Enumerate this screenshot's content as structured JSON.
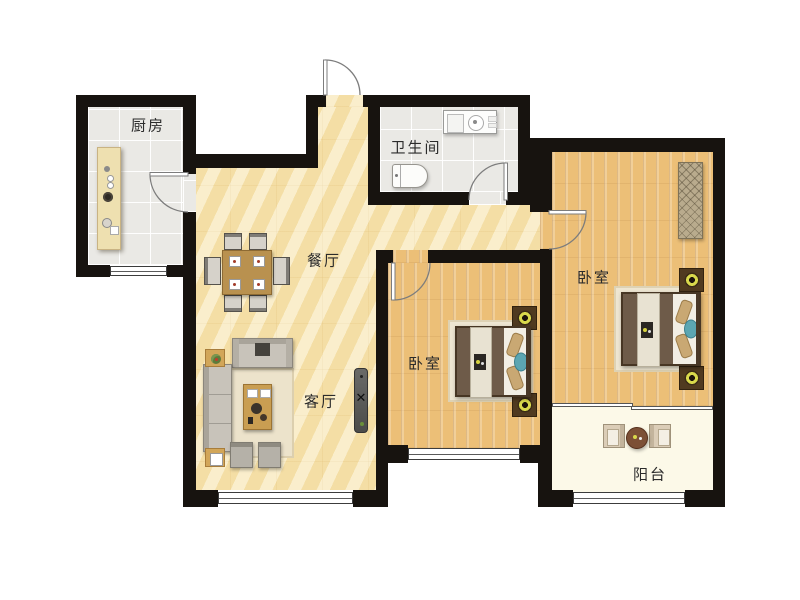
{
  "floorplan": {
    "rooms": {
      "kitchen": {
        "label": "厨房"
      },
      "bathroom": {
        "label": "卫生间"
      },
      "dining": {
        "label": "餐厅"
      },
      "living": {
        "label": "客厅"
      },
      "bedroom_middle": {
        "label": "卧室"
      },
      "bedroom_right": {
        "label": "卧室"
      },
      "balcony": {
        "label": "阳台"
      }
    },
    "colors": {
      "wall": "#17130f",
      "marble_floor": "#f5e2ae",
      "wood_floor": "#ecbf77",
      "tile_floor": "#eae9e5",
      "balcony_floor": "#fcf9e8",
      "label_text": "#2b2b2b"
    },
    "furniture": {
      "kitchen": [
        "counter",
        "sink",
        "stove"
      ],
      "bathroom": [
        "vanity",
        "toilet"
      ],
      "dining": [
        "dining-table",
        "six-chairs"
      ],
      "living": [
        "sofa",
        "chaise-sofa",
        "coffee-table",
        "rug",
        "ottomans",
        "side-tables",
        "tv-stand"
      ],
      "bedroom_middle": [
        "double-bed",
        "nightstands",
        "rug"
      ],
      "bedroom_right": [
        "double-bed",
        "nightstands",
        "wardrobe",
        "rug"
      ],
      "balcony": [
        "round-table",
        "two-chairs"
      ]
    }
  }
}
